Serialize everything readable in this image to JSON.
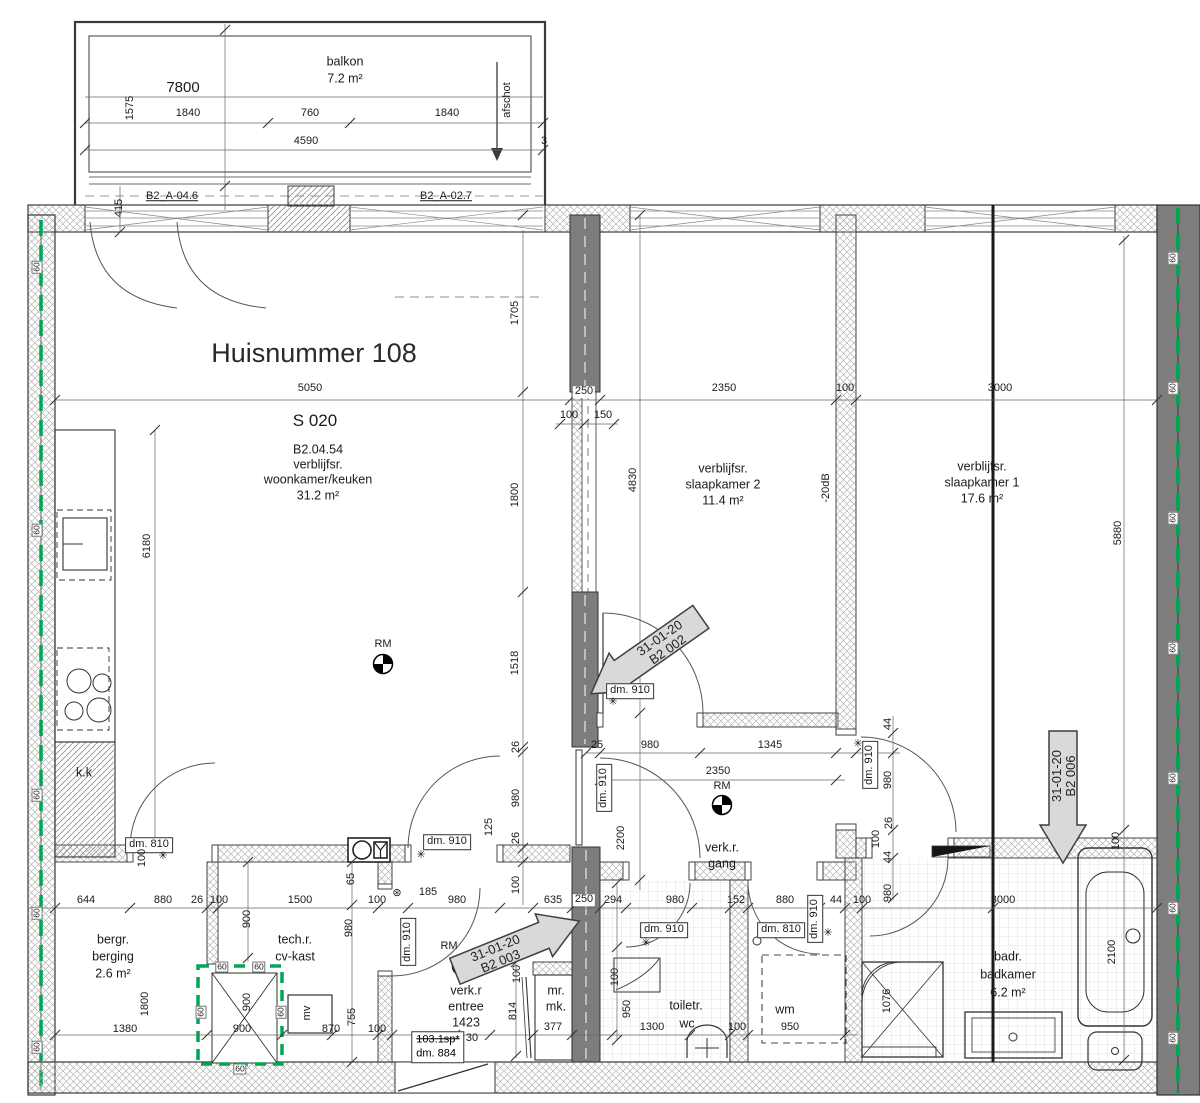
{
  "title": "Huisnummer 108",
  "plan_code": "S 020",
  "balcony": {
    "name": "balkon",
    "area": "7.2 m²",
    "slope": "afschot",
    "door_left": "B2_A-04.6",
    "door_right": "B2_A-02.7"
  },
  "living": {
    "code": "B2.04.54",
    "type": "verblijfsr.",
    "name": "woonkamer/keuken",
    "area": "31.2 m²",
    "kitchen": "k.k"
  },
  "bed2": {
    "type": "verblijfsr.",
    "name": "slaapkamer 2",
    "area": "11.4 m²",
    "acoustic": "-20dB"
  },
  "bed1": {
    "type": "verblijfsr.",
    "name": "slaapkamer 1",
    "area": "17.6 m²"
  },
  "hall": {
    "type": "verk.r.",
    "name": "gang"
  },
  "entree": {
    "type": "verk.r",
    "name": "entree",
    "width": "1423"
  },
  "berging": {
    "type": "bergr.",
    "name": "berging",
    "area": "2.6 m²"
  },
  "tech": {
    "type": "tech.r.",
    "name": "cv-kast"
  },
  "toilet": {
    "type": "toiletr.",
    "name": "wc"
  },
  "bath": {
    "type": "badr.",
    "name": "badkamer",
    "area": "6.2 m²"
  },
  "wm": "wm",
  "mv": "mv",
  "rm": "RM",
  "closet": {
    "l1": "mr.",
    "l2": "mk."
  },
  "stamps": {
    "date": "31-01-20",
    "ref1": "B2 002",
    "ref2": "B2 003",
    "ref3": "B2 006"
  },
  "tags": {
    "d910": "dm. 910",
    "d810": "dm. 810",
    "d884": "dm. 884",
    "sp": "103.1sp*"
  },
  "icons": {
    "sensor": "✳",
    "sensor_circle": "⊛",
    "spy": "◎"
  },
  "colors": {
    "green": "#00a651",
    "dark_wall": "#7d7d7d",
    "stamp_fill": "#d9d9d9"
  },
  "vals": {
    "v7800": "7800",
    "v1575": "1575",
    "v1840": "1840",
    "v760": "760",
    "v4590": "4590",
    "v415": "415",
    "v3": "3",
    "v5050": "5050",
    "v2350": "2350",
    "v100": "100",
    "v150": "150",
    "v250": "250",
    "v3000": "3000",
    "v1705": "1705",
    "v1800": "1800",
    "v1518": "1518",
    "v26": "26",
    "v980": "980",
    "v125": "125",
    "v6180": "6180",
    "v4830": "4830",
    "v2200": "2200",
    "v5880": "5880",
    "v25": "25",
    "v1345": "1345",
    "v44": "44",
    "v644": "644",
    "v880": "880",
    "v1500": "1500",
    "v65": "65",
    "v185": "185",
    "v635": "635",
    "v294": "294",
    "v152": "152",
    "v1380": "1380",
    "v900": "900",
    "v870": "870",
    "v30": "30",
    "v377": "377",
    "v1300": "1300",
    "v950": "950",
    "v814": "814",
    "v755": "755",
    "v1076": "1076",
    "v2100": "2100",
    "v60": "60"
  }
}
